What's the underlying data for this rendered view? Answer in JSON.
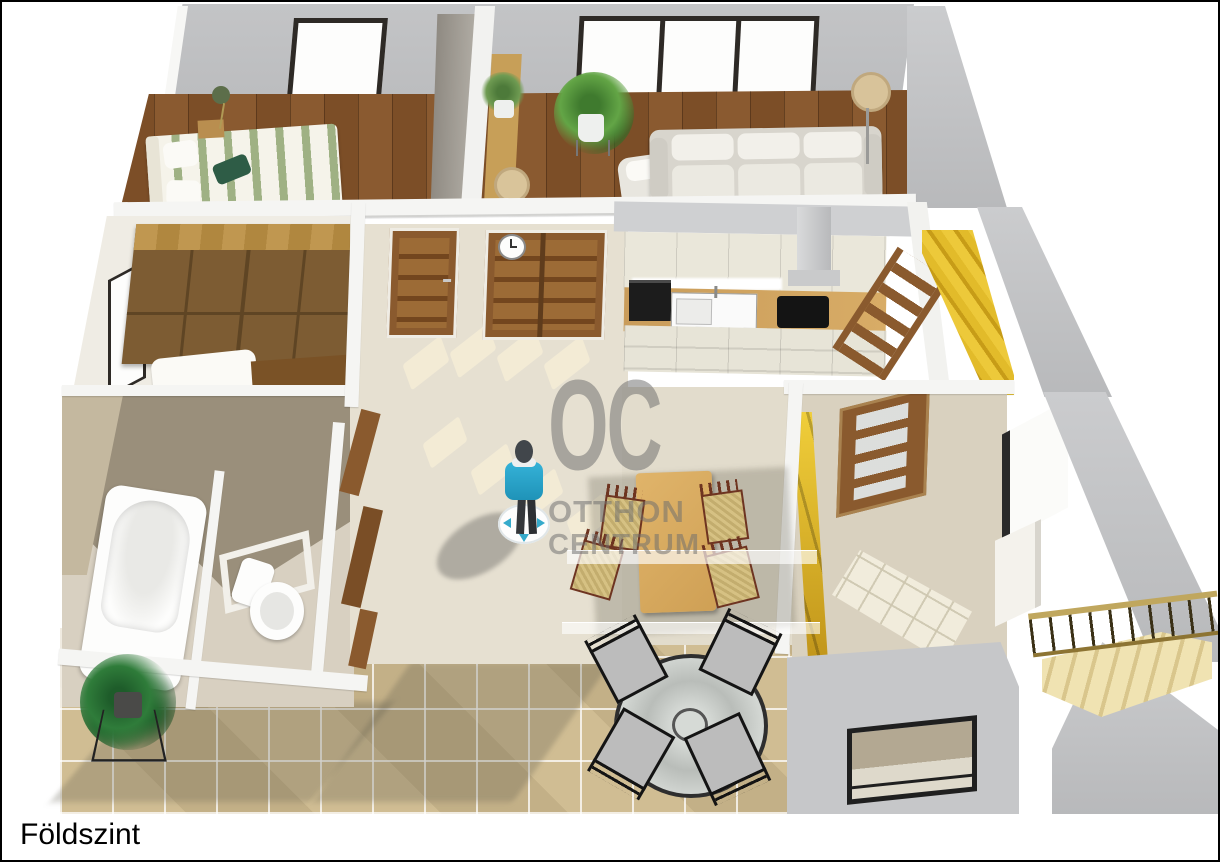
{
  "floor_label": "Földszint",
  "watermark": {
    "monogram": "OC",
    "line1": "OTTHON",
    "line2": "CENTRUM",
    "color": "#6e6e6e"
  },
  "scene": {
    "type": "3d-floorplan-render",
    "view": "birds-eye perspective of a ground floor, walls cut open, white background, thin black border",
    "rooms": [
      {
        "name": "bedroom",
        "floor": "dark wood",
        "items": [
          "double-bed-green-striped",
          "dark-green-cushion",
          "wall-lamp",
          "bedside-table",
          "window",
          "tall-gray-wardrobe"
        ]
      },
      {
        "name": "living-room",
        "floor": "dark wood",
        "items": [
          "triple-window",
          "potted-plant",
          "three-seat-sofa",
          "armchair",
          "floor-lamp",
          "wood-console-with-plant-and-lamp"
        ]
      },
      {
        "name": "walk-in-closet",
        "floor": "light",
        "items": [
          "double-wood-wardrobes",
          "side-window",
          "white-bed",
          "wood-dresser"
        ]
      },
      {
        "name": "hallway",
        "floor": "beige carpet",
        "items": [
          "single-wood-door",
          "double-wood-door",
          "wall-clock",
          "sunlight-patches",
          "navigation-avatar"
        ]
      },
      {
        "name": "kitchen",
        "floor": "beige",
        "items": [
          "cream-cabinets",
          "black-oven",
          "white-sink",
          "wood-countertop",
          "black-cooktop",
          "range-hood"
        ]
      },
      {
        "name": "bathroom",
        "floor": "beige tile",
        "items": [
          "bathtub"
        ]
      },
      {
        "name": "wc",
        "floor": "beige tile",
        "items": [
          "toilet",
          "framed-window"
        ]
      },
      {
        "name": "dining-area",
        "floor": "beige",
        "items": [
          "wood-dining-table",
          "four-wicker-chairs",
          "glass-partition"
        ]
      },
      {
        "name": "stair-hall",
        "floor": "beige tile",
        "items": [
          "glazed-wood-door",
          "yellow-stairs",
          "side-window",
          "front-window",
          "white-tile-patch"
        ]
      },
      {
        "name": "terrace",
        "floor": "stone tiles",
        "items": [
          "potted-plant-on-stand",
          "round-glass-table",
          "four-black-patio-chairs",
          "wood-staircase-with-railing"
        ]
      }
    ],
    "palette": {
      "wall_gray": "#c4c5c7",
      "wall_cap_white": "#f5f5f3",
      "wood_floor": "#7c4e27",
      "beige_floor": "#e6e0d1",
      "terrace_tile": "#cdbb92",
      "door_wood": "#8a5a2e",
      "stairs_yellow": "#e8c02c",
      "avatar_blue": "#2ba7cd",
      "bed_green": "#9fb184"
    }
  }
}
